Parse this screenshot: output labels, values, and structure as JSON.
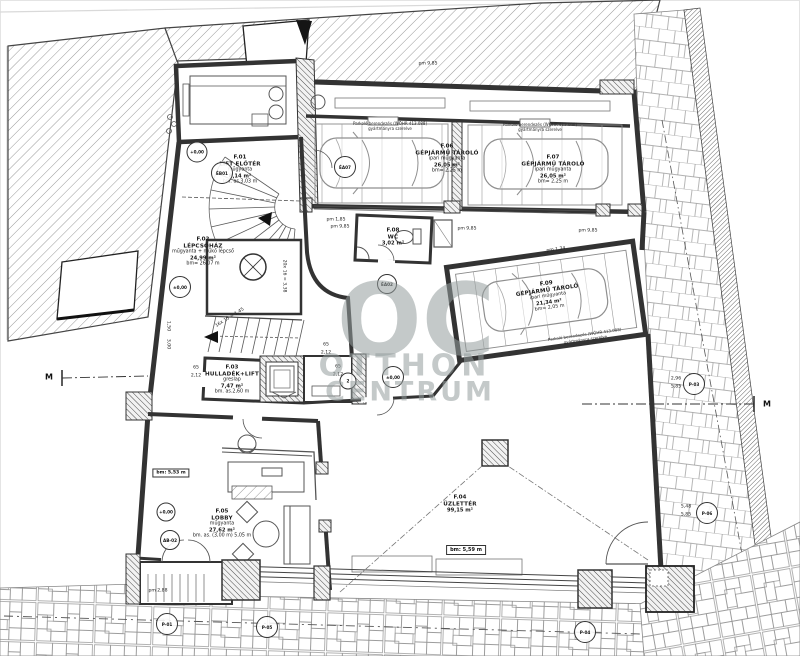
{
  "watermark": {
    "oc": "OC",
    "otthon": "OTTHON",
    "centrum": "CENTRUM"
  },
  "rooms": {
    "lift_lobby": {
      "id": "F.01",
      "name": "LIFT ELŐTÉR",
      "finish": "műgyanta",
      "area": "8,14 m²",
      "height": "bm. as.3,03 m"
    },
    "staircase": {
      "id": "F.02",
      "name": "LÉPCSŐHÁZ",
      "finish": "műgyanta + műkő lépcső",
      "area": "24,99 m²",
      "height": "bm= 26,07 m"
    },
    "waste_lift": {
      "id": "F.03",
      "name": "HULLADÉK+LIFT",
      "finish": "greslap",
      "area": "7,47 m²",
      "height": "bm. as.2,60 m"
    },
    "retail": {
      "id": "F.04",
      "name": "ÜZLETTÉR",
      "area": "99,15 m²",
      "height_box": "bm: 5,59 m"
    },
    "lobby": {
      "id": "F.05",
      "name": "LOBBY",
      "finish": "műgyanta",
      "area": "27,62 m²",
      "height": "bm. as. (3,00 m) 5,05 m",
      "height_box": "bm: 5,53 m"
    },
    "garage1": {
      "id": "F.06",
      "name": "GÉPJÁRMŰ TÁROLÓ",
      "finish": "ipari műgyanta",
      "area": "26,05 m²",
      "height": "bm= 2,25 m"
    },
    "garage2": {
      "id": "F.07",
      "name": "GÉPJÁRMŰ TÁROLÓ",
      "finish": "ipari műgyanta",
      "area": "26,05 m²",
      "height": "bm= 2,25 m"
    },
    "wc": {
      "id": "F.08",
      "name": "WC",
      "area": "3,02 m²"
    },
    "garage3": {
      "id": "F.09",
      "name": "GÉPJÁRMŰ TÁROLÓ",
      "finish": "ipari műgyanta",
      "area": "21,34 m²",
      "height": "bm= 2,05 m"
    }
  },
  "notes": {
    "parking_line1": "Parkoló berendezés (WÖHR 413.088)",
    "parking_line2": "gyártmányra szerelve"
  },
  "section": {
    "label": "M"
  },
  "levels": {
    "zero_plus": "+0,00",
    "zero_pm": "±0,00"
  },
  "markers": {
    "eb01": "ÉB01",
    "ea07": "ÉA07",
    "ea02": "ÉA02",
    "ab02": "AB-02",
    "door": "2",
    "p01": "P-01",
    "p03": "P-03",
    "p04": "P-04",
    "p05": "P-05",
    "p06": "P-06"
  },
  "dims": {
    "pm985": "pm 9,85",
    "pm134": "pm 1,34",
    "pm288": "pm 2,88",
    "pm185": "pm 1,85",
    "w65": "65",
    "h212": "2,12",
    "stair_run1": "16x 15 = 1,45",
    "stair_run2": "20x 16 = 3,38",
    "d296": "2,96",
    "d585": "5,85",
    "d548": "5,48",
    "d150": "1,50",
    "d300": "3,00"
  }
}
